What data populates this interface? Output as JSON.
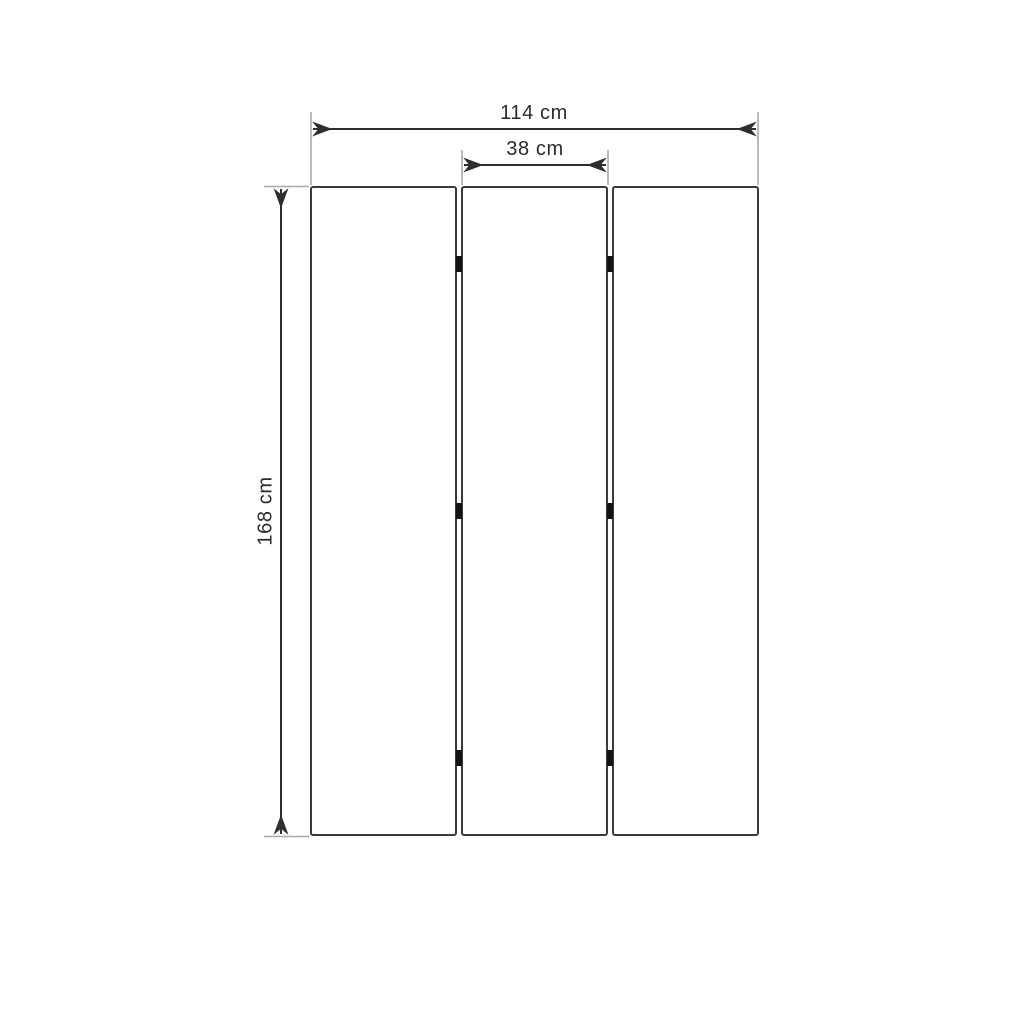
{
  "diagram": {
    "kind": "technical-dimension-drawing",
    "panels_count": 3,
    "hinge_marks_count": 6,
    "dimensions": {
      "total_width": {
        "label": "114 cm",
        "value": 114,
        "unit": "cm"
      },
      "panel_width": {
        "label": "38 cm",
        "value": 38,
        "unit": "cm"
      },
      "height": {
        "label": "168 cm",
        "value": 168,
        "unit": "cm"
      }
    },
    "colors": {
      "background": "#ffffff",
      "panel_outline": "#3a3a3a",
      "dimension_line": "#2e2e2e",
      "extension_line": "#a8a8a8",
      "hinge": "#141414",
      "text": "#2b2b2b"
    }
  }
}
